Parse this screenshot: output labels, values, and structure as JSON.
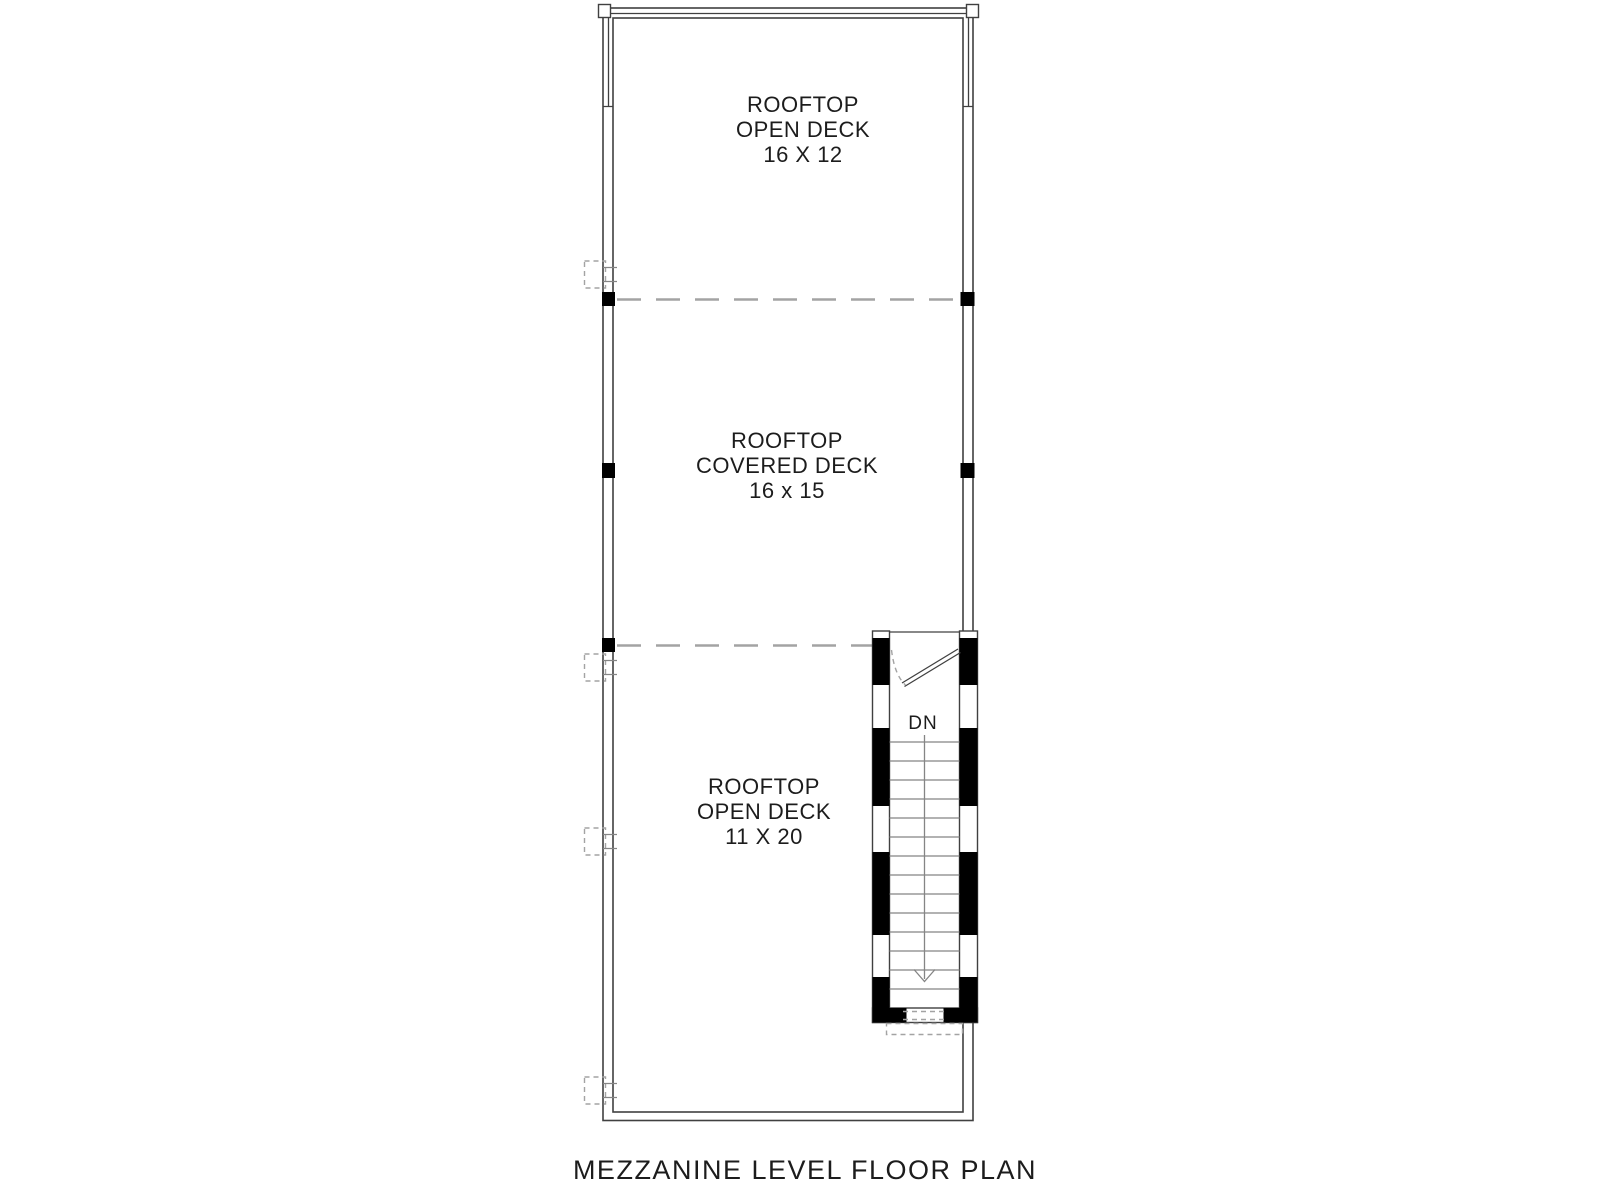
{
  "drawing": {
    "title": "MEZZANINE LEVEL FLOOR PLAN",
    "rooms": [
      {
        "name_line1": "ROOFTOP",
        "name_line2": "OPEN DECK",
        "dimensions": "16 X 12"
      },
      {
        "name_line1": "ROOFTOP",
        "name_line2": "COVERED DECK",
        "dimensions": "16 x 15"
      },
      {
        "name_line1": "ROOFTOP",
        "name_line2": "OPEN DECK",
        "dimensions": "11 X 20"
      }
    ],
    "stair": {
      "direction_label": "DN"
    },
    "colors": {
      "ink": "#404040",
      "post": "#000000",
      "dash": "#a3a3a3",
      "tread": "#858585",
      "text": "#1c1c1c",
      "paper": "#ffffff"
    }
  }
}
